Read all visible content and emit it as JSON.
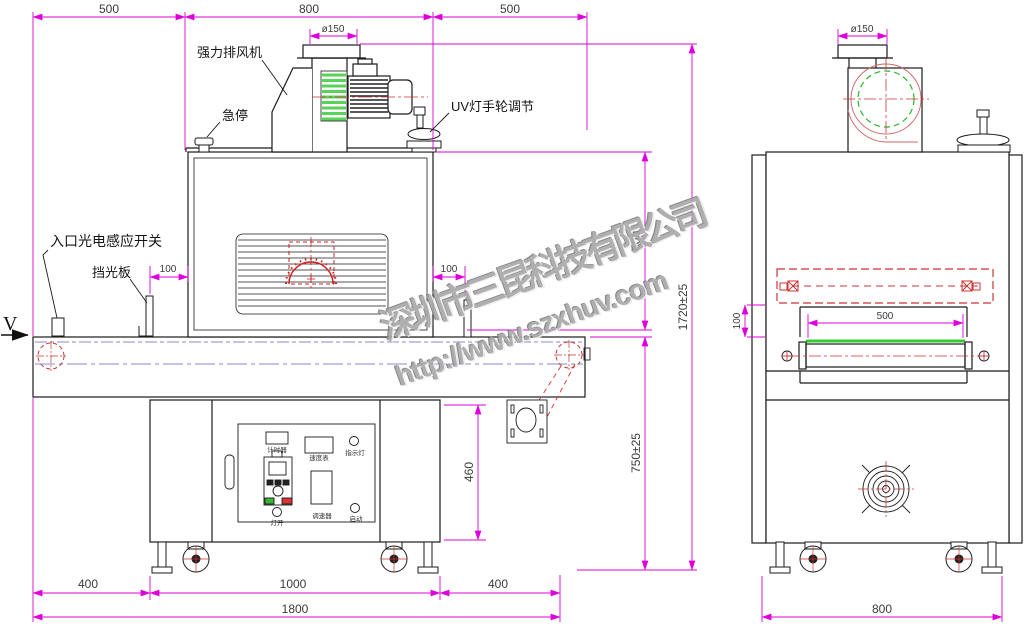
{
  "watermark": {
    "company": "深圳市三昆科技有限公司",
    "url": "http://www.szxhuv.com"
  },
  "front_view": {
    "direction_mark": "V",
    "labels": {
      "exhaust_fan": "强力排风机",
      "emergency_stop": "急停",
      "uv_handwheel": "UV灯手轮调节",
      "entry_sensor": "入口光电感应开关",
      "light_shield": "挡光板"
    },
    "control_panel": {
      "timer": "计时器",
      "speed_meter": "速度表",
      "indicator_light": "指示灯",
      "lamp_switch": "灯开",
      "speed_controller": "调速器",
      "start_button": "启动"
    },
    "dimensions": {
      "top_left": "500",
      "top_center": "800",
      "top_right": "500",
      "duct_diameter": "ø150",
      "shield_left": "100",
      "shield_right": "100",
      "chamber_height": "600",
      "total_height": "1720±25",
      "belt_height": "750±25",
      "cabinet_height": "460",
      "base_left": "400",
      "base_center": "1000",
      "base_right": "400",
      "total_length": "1800"
    }
  },
  "side_view": {
    "dimensions": {
      "duct_diameter": "ø150",
      "lamp_to_belt": "100",
      "belt_width": "500",
      "base_width": "800"
    }
  }
}
